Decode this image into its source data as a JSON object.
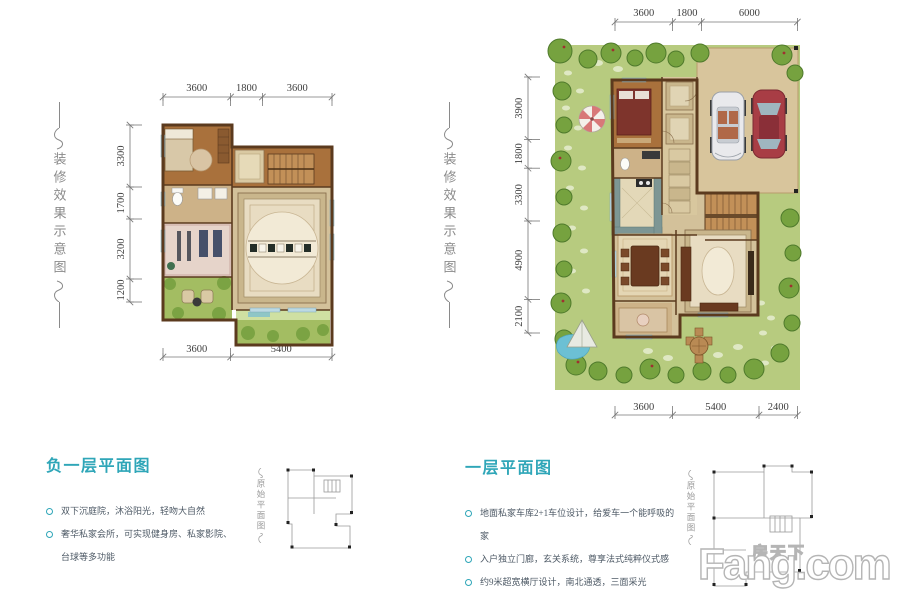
{
  "colors": {
    "title_teal": "#2fa6b8",
    "bullet_text": "#4e5a66",
    "dim_text": "#3f3f3f",
    "deco_gray": "#8a8a8a",
    "sketch_gray": "#9a9a9a",
    "wall_brown": "#5b3a1e",
    "wood_floor": "#a9713c",
    "wood_light": "#c29058",
    "tile_tan": "#d8c79e",
    "tile_dark": "#cdb288",
    "hall_floor": "#d3c19a",
    "carpet_cream": "#e8dcc2",
    "carpet_border": "#c9b68c",
    "gym_pink": "#e6d4ca",
    "courtyard_green": "#a3bd62",
    "garden_green": "#b7cb7f",
    "tree_green": "#76a23f",
    "tree_dark": "#4f7a2c",
    "parking_tan": "#d8c59c",
    "car_red": "#a83d45",
    "car_white": "#e9e9ec",
    "water_blue": "#6cc0d4",
    "window_blue": "#bcd9e2",
    "watermark_outline": "#b5b5b5"
  },
  "decorations": {
    "vertical_caption": "装修效果示意图",
    "sketch_caption": "原始平面图"
  },
  "watermark": {
    "cn": "房天下",
    "en": "Fang.com"
  },
  "basement": {
    "title": "负一层平面图",
    "bullets": [
      "双下沉庭院，沐浴阳光，轻吻大自然",
      "奢华私家会所，可实现健身房、私家影院、台球等多功能"
    ],
    "dims": {
      "top": [
        "3600",
        "1800",
        "3600"
      ],
      "left": [
        "3300",
        "1700",
        "3200",
        "1200"
      ],
      "bottom": [
        "3600",
        "5400"
      ]
    }
  },
  "first_floor": {
    "title": "一层平面图",
    "bullets": [
      "地面私家车库2+1车位设计，给爱车一个能呼吸的家",
      "入户独立门廊，玄关系统，尊享法式纯粹仪式感",
      "约9米超宽横厅设计，南北通透，三面采光"
    ],
    "dims": {
      "top": [
        "3600",
        "1800",
        "6000"
      ],
      "left": [
        "3900",
        "1800",
        "3300",
        "4900",
        "2100"
      ],
      "bottom": [
        "3600",
        "5400",
        "2400"
      ]
    }
  }
}
